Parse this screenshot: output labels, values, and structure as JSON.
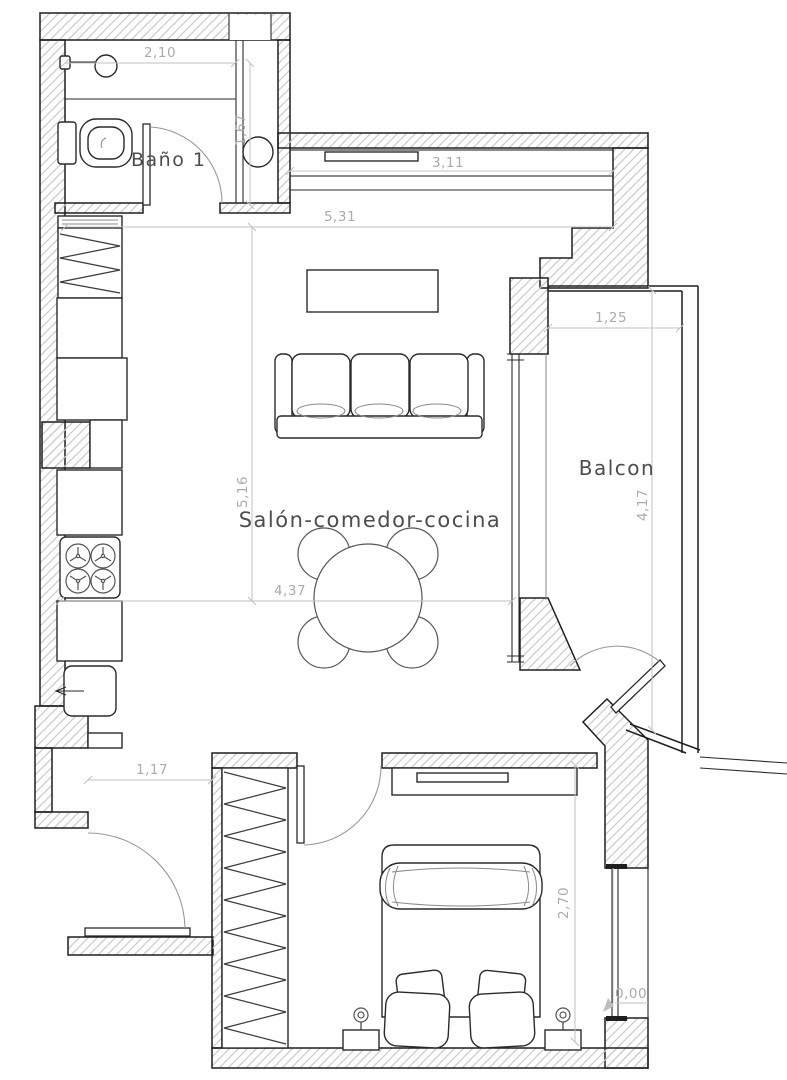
{
  "plan": {
    "rooms": {
      "bathroom": "Baño 1",
      "living": "Salón-comedor-cocina",
      "balcony": "Balcon"
    },
    "dims": {
      "bath_width": "2,10",
      "shaft_height": "1,67",
      "window_width": "3,11",
      "living_width": "5,31",
      "balcony_width": "1,25",
      "living_height": "5,16",
      "balcony_height": "4,17",
      "dining_width": "4,37",
      "entry_width": "1,17",
      "bedroom_height": "2,70",
      "level": "0,00"
    },
    "colors": {
      "background": "#ffffff",
      "wall_line": "#1f1f1f",
      "wall_hatch": "#cacaca",
      "dimension_line": "#c0c0c0",
      "dimension_text": "#ababab",
      "label_text": "#4d4d4d"
    },
    "furniture_icons": {
      "bathroom": [
        "sink",
        "toilet",
        "water-heater"
      ],
      "kitchen": [
        "vent-shelf",
        "appliance",
        "cabinets",
        "stove",
        "kitchen-sink"
      ],
      "living": [
        "wall-shelf",
        "tv-unit",
        "sofa",
        "dining-table",
        "chairs"
      ],
      "bedroom": [
        "wardrobe",
        "sideboard",
        "double-bed",
        "pillows",
        "nightstands",
        "lamps"
      ]
    }
  }
}
